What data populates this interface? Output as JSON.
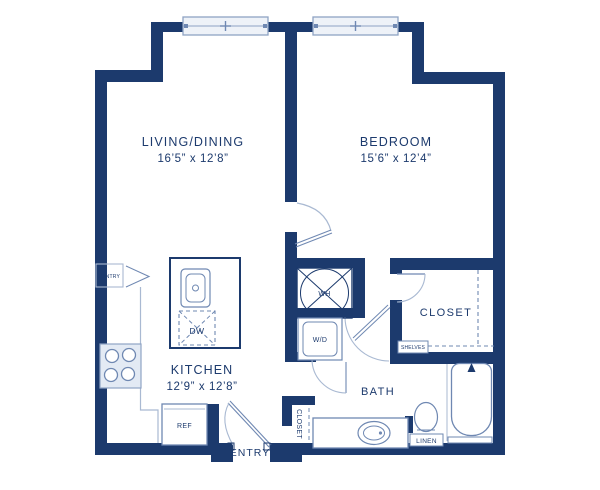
{
  "title": "One bedroom apartment floor plan",
  "colors": {
    "wall": "#1c3a6d",
    "fixture": "#6f88b2",
    "light": "#a9b9d2",
    "winfill": "#eef2f8",
    "bg": "#ffffff"
  },
  "rooms": {
    "living_dining": {
      "label": "LIVING/DINING",
      "dimensions": "16’5” x 12’8”"
    },
    "bedroom": {
      "label": "BEDROOM",
      "dimensions": "15’6” x 12’4”"
    },
    "kitchen": {
      "label": "KITCHEN",
      "dimensions": "12’9” x 12’8”"
    },
    "bath": {
      "label": "BATH"
    },
    "closet": {
      "label": "CLOSET"
    },
    "entry": {
      "label": "ENTRY"
    },
    "entry_closet": {
      "label": "CLOSET"
    }
  },
  "fixtures": {
    "pantry": "PANTRY",
    "water_heater": "WH",
    "washer_dryer": "W/D",
    "dishwasher": "DW",
    "refrigerator": "REF",
    "shelves": "SHELVES",
    "linen": "LINEN"
  }
}
